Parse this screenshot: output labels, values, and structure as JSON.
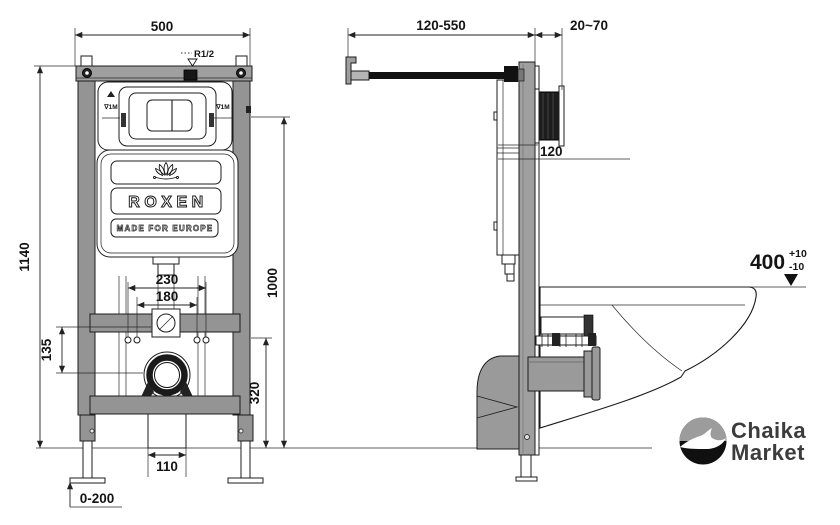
{
  "front_view": {
    "dim_width": "500",
    "dim_height": "1140",
    "dim_flush_center_height": "1000",
    "dim_bracket_offset": "135",
    "dim_outlet_height": "320",
    "dim_studs_outer": "230",
    "dim_studs_inner": "180",
    "dim_outlet_width": "110",
    "dim_foot_adjust": "0-200",
    "inlet_label": "R1/2",
    "water_mark_left": "∇1M",
    "water_mark_right": "∇1M",
    "cistern": {
      "brand": "ROXEN",
      "tagline": "MADE FOR EUROPE",
      "logo_icon": "lotus-icon"
    }
  },
  "side_view": {
    "dim_rod_range": "120-550",
    "dim_wall_finish": "20~70",
    "dim_plate_depth": "120",
    "dim_bowl_height": "400",
    "dim_bowl_height_tol_plus": "+10",
    "dim_bowl_height_tol_minus": "-10"
  },
  "branding": {
    "name_line1": "Chaika",
    "name_line2": "Market",
    "logo_icon": "seagull-icon"
  },
  "colors": {
    "line": "#1c1c1c",
    "frame_gray": "#949494",
    "top_bar_gray": "#9f9f9f",
    "pipe_gray": "#9a9a9a",
    "dark": "#161616",
    "background": "#ffffff",
    "logo_top": "#9c9c9c",
    "logo_bottom": "#101010",
    "logo_text": "#3c3c3c"
  }
}
